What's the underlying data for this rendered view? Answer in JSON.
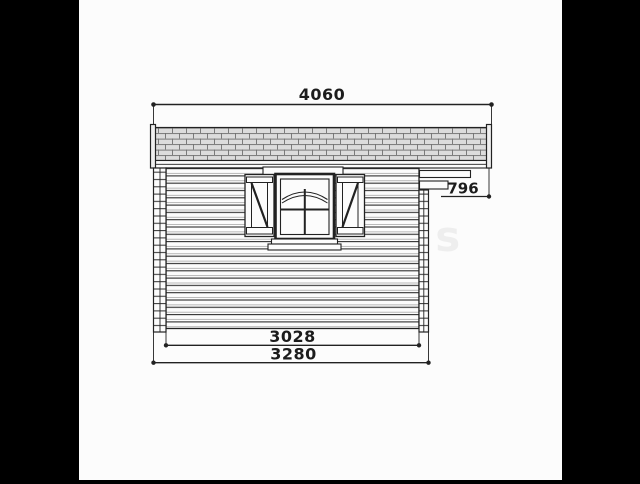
{
  "drawing": {
    "type": "shed-side-elevation-technical-drawing",
    "dimensions": {
      "roof_width": "4060",
      "overhang": "796",
      "inner_width": "3028",
      "outer_width": "3280"
    },
    "watermark": "blaudetells",
    "colors": {
      "letterbox_bars": "#000000",
      "paper": "#fcfcfc",
      "line": "#222222",
      "shingle_fill": "#dcdcdc",
      "shingle_line": "#707070"
    }
  }
}
